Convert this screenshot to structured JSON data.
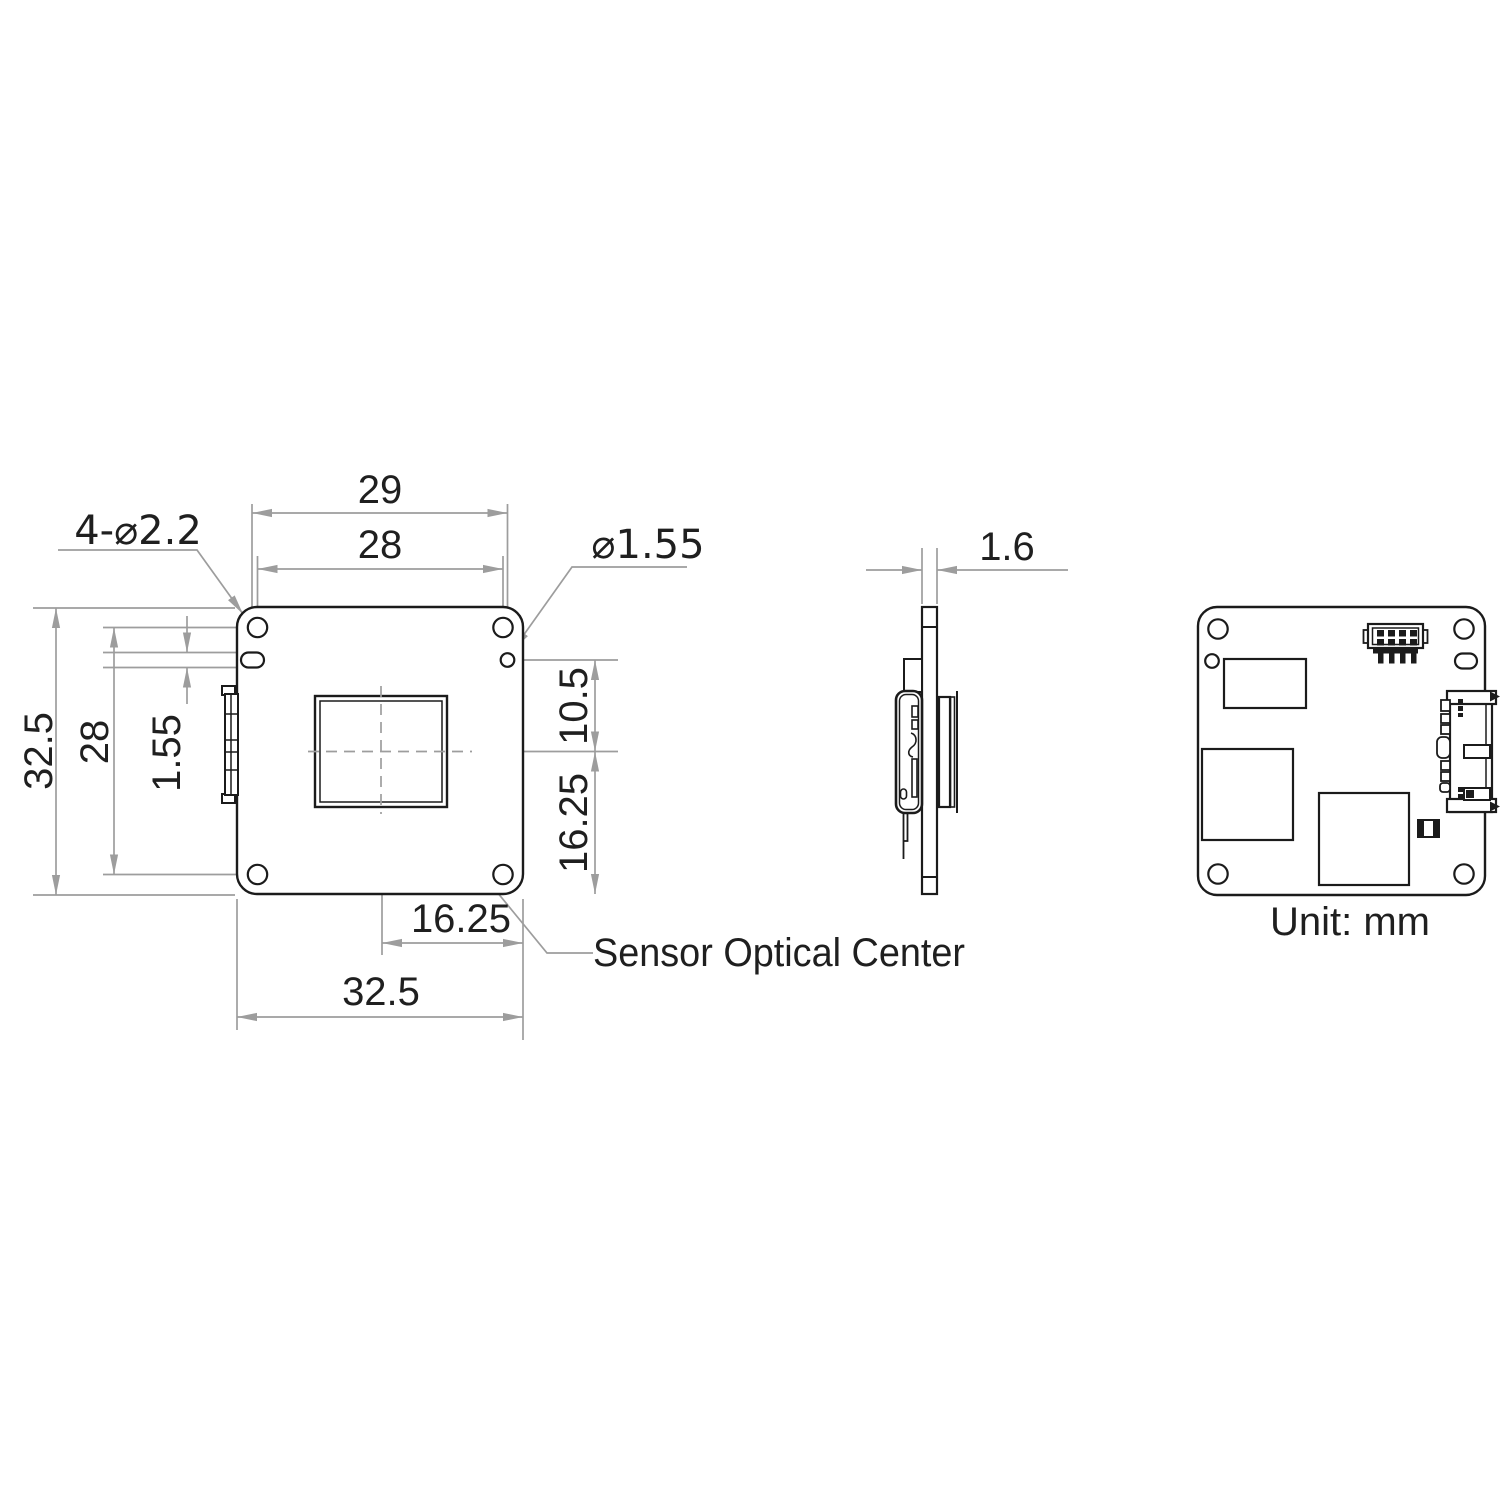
{
  "drawing": {
    "front": {
      "dim_top_outer": "29",
      "dim_top_inner": "28",
      "dim_left_outer": "32.5",
      "dim_left_inner": "28",
      "dim_slot": "1.55",
      "dim_right_upper": "10.5",
      "dim_right_lower": "16.25",
      "dim_bottom_inner": "16.25",
      "dim_bottom_outer": "32.5",
      "label_corner_holes": "4-⌀2.2",
      "label_small_hole": "⌀1.55",
      "label_sensor_center": "Sensor Optical Center"
    },
    "side": {
      "dim_thickness": "1.6"
    },
    "back": {
      "unit_note": "Unit: mm"
    },
    "colors": {
      "line": "#1b1b1b",
      "dimension": "#9d9d9d",
      "text": "#1f1f1f"
    }
  }
}
